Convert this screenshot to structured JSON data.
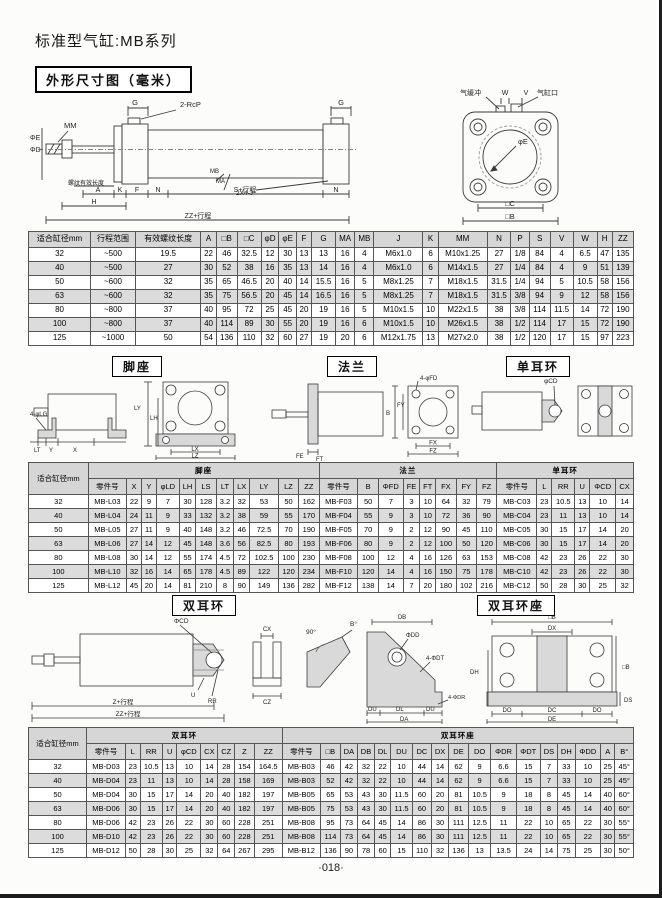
{
  "page": {
    "title": "标准型气缸:MB系列",
    "section_title": "外形尺寸图（毫米）",
    "footer": "·018·"
  },
  "figs": {
    "side": {
      "mm": "MM",
      "g_left": "G",
      "rcp": "2-RcP",
      "g_right": "G",
      "phi_e": "ΦE",
      "phi_d": "ΦD",
      "thread_note": "螺纹有效长度",
      "mb": "MB",
      "ma": "MA",
      "tie_rod": "2X4-J",
      "a": "A",
      "h": "H",
      "k": "K",
      "f": "F",
      "n": "N",
      "n_right": "N",
      "s": "S+行程",
      "zz": "ZZ+行程"
    },
    "end": {
      "cushion": "气缓冲",
      "w": "W",
      "v": "V",
      "port": "气缸口",
      "phi_e": "φE",
      "c": "□C",
      "b": "□B"
    },
    "foot": {
      "title": "脚座",
      "lg": "4-φLG",
      "lt": "LT",
      "y": "Y",
      "x": "X",
      "ly": "LY",
      "lh": "LH",
      "lx": "LX",
      "lz": "LZ"
    },
    "flange": {
      "title": "法兰",
      "fd": "4-φFD",
      "b": "B",
      "fy": "FY",
      "fe": "FE",
      "ft": "FT",
      "fx": "FX",
      "fz": "FZ"
    },
    "sclevis": {
      "title": "单耳环",
      "cd": "φCD"
    },
    "dclevis": {
      "title": "双耳环",
      "cd": "ΦCD",
      "u": "U",
      "rr": "RR",
      "z": "Z+行程",
      "zz": "ZZ+行程",
      "cx": "CX",
      "cz": "CZ"
    },
    "angle": {
      "a90": "90°",
      "b": "B°"
    },
    "bracket": {
      "title": "双耳环座",
      "db": "DB",
      "dd": "ΦDD",
      "dt": "4-ΦDT",
      "du1": "DU",
      "dl": "DL",
      "du2": "DU",
      "da": "DA",
      "dr": "4-ΦDR",
      "b_top": "□B",
      "dx": "DX",
      "b_right": "□B",
      "dh": "DH",
      "ds": "DS",
      "do1": "DO",
      "dc": "DC",
      "do2": "DO",
      "de": "DE"
    }
  },
  "table1": {
    "headers": [
      "适合缸径mm",
      "行程范围",
      "有效螺纹长度",
      "A",
      "□B",
      "□C",
      "φD",
      "φE",
      "F",
      "G",
      "MA",
      "MB",
      "J",
      "K",
      "MM",
      "N",
      "P",
      "S",
      "V",
      "W",
      "H",
      "ZZ"
    ],
    "rows": [
      [
        "32",
        "~500",
        "19.5",
        "22",
        "46",
        "32.5",
        "12",
        "30",
        "13",
        "13",
        "16",
        "4",
        "M6x1.0",
        "6",
        "M10x1.25",
        "27",
        "1/8",
        "84",
        "4",
        "6.5",
        "47",
        "135"
      ],
      [
        "40",
        "~500",
        "27",
        "30",
        "52",
        "38",
        "16",
        "35",
        "13",
        "14",
        "16",
        "4",
        "M6x1.0",
        "6",
        "M14x1.5",
        "27",
        "1/4",
        "84",
        "4",
        "9",
        "51",
        "139"
      ],
      [
        "50",
        "~600",
        "32",
        "35",
        "65",
        "46.5",
        "20",
        "40",
        "14",
        "15.5",
        "16",
        "5",
        "M8x1.25",
        "7",
        "M18x1.5",
        "31.5",
        "1/4",
        "94",
        "5",
        "10.5",
        "58",
        "156"
      ],
      [
        "63",
        "~600",
        "32",
        "35",
        "75",
        "56.5",
        "20",
        "45",
        "14",
        "16.5",
        "16",
        "5",
        "M8x1.25",
        "7",
        "M18x1.5",
        "31.5",
        "3/8",
        "94",
        "9",
        "12",
        "58",
        "156"
      ],
      [
        "80",
        "~800",
        "37",
        "40",
        "95",
        "72",
        "25",
        "45",
        "20",
        "19",
        "16",
        "5",
        "M10x1.5",
        "10",
        "M22x1.5",
        "38",
        "3/8",
        "114",
        "11.5",
        "14",
        "72",
        "190"
      ],
      [
        "100",
        "~800",
        "37",
        "40",
        "114",
        "89",
        "30",
        "55",
        "20",
        "19",
        "16",
        "6",
        "M10x1.5",
        "10",
        "M26x1.5",
        "38",
        "1/2",
        "114",
        "17",
        "15",
        "72",
        "190"
      ],
      [
        "125",
        "~1000",
        "50",
        "54",
        "136",
        "110",
        "32",
        "60",
        "27",
        "19",
        "20",
        "6",
        "M12x1.75",
        "13",
        "M27x2.0",
        "38",
        "1/2",
        "120",
        "17",
        "15",
        "97",
        "223"
      ]
    ]
  },
  "table2": {
    "bore_header": "适合缸径mm",
    "groups": [
      {
        "title": "脚座",
        "headers": [
          "零件号",
          "X",
          "Y",
          "φLD",
          "LH",
          "LS",
          "LT",
          "LX",
          "LY",
          "LZ",
          "ZZ"
        ]
      },
      {
        "title": "法兰",
        "headers": [
          "零件号",
          "B",
          "ΦFD",
          "FE",
          "FT",
          "FX",
          "FY",
          "FZ"
        ]
      },
      {
        "title": "单耳环",
        "headers": [
          "零件号",
          "L",
          "RR",
          "U",
          "ΦCD",
          "CX"
        ]
      }
    ],
    "rows": [
      [
        "32",
        "MB-L03",
        "22",
        "9",
        "7",
        "30",
        "128",
        "3.2",
        "32",
        "53",
        "50",
        "162",
        "MB-F03",
        "50",
        "7",
        "3",
        "10",
        "64",
        "32",
        "79",
        "MB-C03",
        "23",
        "10.5",
        "13",
        "10",
        "14"
      ],
      [
        "40",
        "MB-L04",
        "24",
        "11",
        "9",
        "33",
        "132",
        "3.2",
        "38",
        "59",
        "55",
        "170",
        "MB-F04",
        "55",
        "9",
        "3",
        "10",
        "72",
        "36",
        "90",
        "MB-C04",
        "23",
        "11",
        "13",
        "10",
        "14"
      ],
      [
        "50",
        "MB-L05",
        "27",
        "11",
        "9",
        "40",
        "148",
        "3.2",
        "46",
        "72.5",
        "70",
        "190",
        "MB-F05",
        "70",
        "9",
        "2",
        "12",
        "90",
        "45",
        "110",
        "MB-C05",
        "30",
        "15",
        "17",
        "14",
        "20"
      ],
      [
        "63",
        "MB-L06",
        "27",
        "14",
        "12",
        "45",
        "148",
        "3.6",
        "56",
        "82.5",
        "80",
        "193",
        "MB-F06",
        "80",
        "9",
        "2",
        "12",
        "100",
        "50",
        "120",
        "MB-C06",
        "30",
        "15",
        "17",
        "14",
        "20"
      ],
      [
        "80",
        "MB-L08",
        "30",
        "14",
        "12",
        "55",
        "174",
        "4.5",
        "72",
        "102.5",
        "100",
        "230",
        "MB-F08",
        "100",
        "12",
        "4",
        "16",
        "126",
        "63",
        "153",
        "MB-C08",
        "42",
        "23",
        "26",
        "22",
        "30"
      ],
      [
        "100",
        "MB-L10",
        "32",
        "16",
        "14",
        "65",
        "178",
        "4.5",
        "89",
        "122",
        "120",
        "234",
        "MB-F10",
        "120",
        "14",
        "4",
        "16",
        "150",
        "75",
        "178",
        "MB-C10",
        "42",
        "23",
        "26",
        "22",
        "30"
      ],
      [
        "125",
        "MB-L12",
        "45",
        "20",
        "14",
        "81",
        "210",
        "8",
        "90",
        "149",
        "136",
        "282",
        "MB-F12",
        "138",
        "14",
        "7",
        "20",
        "180",
        "102",
        "216",
        "MB-C12",
        "50",
        "28",
        "30",
        "25",
        "32"
      ]
    ]
  },
  "table3": {
    "bore_header": "适合缸径mm",
    "groups": [
      {
        "title": "双耳环",
        "headers": [
          "零件号",
          "L",
          "RR",
          "U",
          "φCD",
          "CX",
          "CZ",
          "Z",
          "ZZ"
        ]
      },
      {
        "title": "双耳环座",
        "headers": [
          "零件号",
          "□B",
          "DA",
          "DB",
          "DL",
          "DU",
          "DC",
          "DX",
          "DE",
          "DO",
          "ΦDR",
          "ΦDT",
          "DS",
          "DH",
          "ΦDD",
          "A",
          "B°"
        ]
      }
    ],
    "rows": [
      [
        "32",
        "MB-D03",
        "23",
        "10.5",
        "13",
        "10",
        "14",
        "28",
        "154",
        "164.5",
        "MB-B03",
        "46",
        "42",
        "32",
        "22",
        "10",
        "44",
        "14",
        "62",
        "9",
        "6.6",
        "15",
        "7",
        "33",
        "10",
        "25",
        "45°"
      ],
      [
        "40",
        "MB-D04",
        "23",
        "11",
        "13",
        "10",
        "14",
        "28",
        "158",
        "169",
        "MB-B03",
        "52",
        "42",
        "32",
        "22",
        "10",
        "44",
        "14",
        "62",
        "9",
        "6.6",
        "15",
        "7",
        "33",
        "10",
        "25",
        "45°"
      ],
      [
        "50",
        "MB-D04",
        "30",
        "15",
        "17",
        "14",
        "20",
        "40",
        "182",
        "197",
        "MB-B05",
        "65",
        "53",
        "43",
        "30",
        "11.5",
        "60",
        "20",
        "81",
        "10.5",
        "9",
        "18",
        "8",
        "45",
        "14",
        "40",
        "60°"
      ],
      [
        "63",
        "MB-D06",
        "30",
        "15",
        "17",
        "14",
        "20",
        "40",
        "182",
        "197",
        "MB-B05",
        "75",
        "53",
        "43",
        "30",
        "11.5",
        "60",
        "20",
        "81",
        "10.5",
        "9",
        "18",
        "8",
        "45",
        "14",
        "40",
        "60°"
      ],
      [
        "80",
        "MB-D06",
        "42",
        "23",
        "26",
        "22",
        "30",
        "60",
        "228",
        "251",
        "MB-B08",
        "95",
        "73",
        "64",
        "45",
        "14",
        "86",
        "30",
        "111",
        "12.5",
        "11",
        "22",
        "10",
        "65",
        "22",
        "30",
        "55°"
      ],
      [
        "100",
        "MB-D10",
        "42",
        "23",
        "26",
        "22",
        "30",
        "60",
        "228",
        "251",
        "MB-B08",
        "114",
        "73",
        "64",
        "45",
        "14",
        "86",
        "30",
        "111",
        "12.5",
        "11",
        "22",
        "10",
        "65",
        "22",
        "30",
        "55°"
      ],
      [
        "125",
        "MB-D12",
        "50",
        "28",
        "30",
        "25",
        "32",
        "64",
        "267",
        "295",
        "MB-B12",
        "136",
        "90",
        "78",
        "60",
        "15",
        "110",
        "32",
        "136",
        "13",
        "13.5",
        "24",
        "14",
        "75",
        "25",
        "30",
        "50°"
      ]
    ]
  }
}
